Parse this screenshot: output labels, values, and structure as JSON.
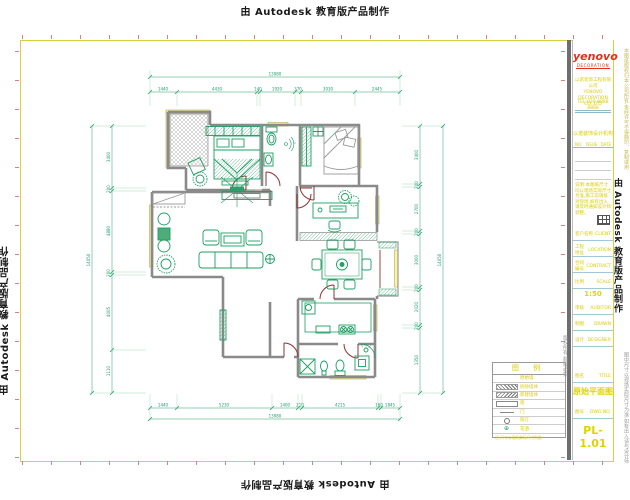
{
  "watermark": "由 Autodesk 教育版产品制作",
  "title_block": {
    "logo_text": "yenovo",
    "logo_sub": "DECORATION",
    "company_cn": "以诺装饰工程有限公司",
    "company_en": "YENOVO DECORATION CO.,LTD",
    "company_tel": "TEL:020-8888 8888",
    "company_line": "以诺装饰设计机构",
    "rev": {
      "no": "NO.",
      "issue": "ISSUE",
      "date": "DATE"
    },
    "para": "说明:本图纸尺寸均以现场实际尺寸为准,施工前请核对现场,如有出入请及时通知设计师调整。",
    "fields": [
      {
        "label": "客户名称",
        "en": "CLIENT",
        "value": ""
      },
      {
        "label": "工程地址",
        "en": "LOCATION",
        "value": ""
      },
      {
        "label": "合同编号",
        "en": "CONTRACT",
        "value": ""
      },
      {
        "label": "比例",
        "en": "SCALE",
        "value": "1:50"
      },
      {
        "label": "审核",
        "en": "AUDITOR",
        "value": ""
      },
      {
        "label": "制图",
        "en": "DRAWN",
        "value": ""
      },
      {
        "label": "设计",
        "en": "DESIGNER",
        "value": ""
      },
      {
        "label": "图名",
        "en": "TITLE",
        "value": "原始平面图"
      },
      {
        "label": "图号",
        "en": "DWG NO.",
        "value": "PL-1.01"
      }
    ],
    "drawing_name": "原始平面图",
    "drawing_no": "PL-1.01"
  },
  "legend": {
    "title": "图 例",
    "rows": [
      {
        "label": "原始墙"
      },
      {
        "label": "拆除墙体"
      },
      {
        "label": "新建墙体"
      },
      {
        "label": "窗"
      },
      {
        "label": "门"
      },
      {
        "label": "筒灯"
      },
      {
        "label": "花洒",
        "glyph": "⊕"
      }
    ],
    "footnote": "注:尺寸以现场实际尺寸为准"
  },
  "side_notes": {
    "right_top": "本图纸版权归本公司所有,未经许可不得翻印、复制或用于其他用途。",
    "right_bottom": "图中尺寸以现场实际尺寸为准,如有出入请与设计师联系。",
    "inner_left": "版权所有 翻版必究"
  },
  "dimensions": {
    "top": {
      "total": "13980",
      "segments": [
        "1440",
        "4430",
        "140",
        "1920",
        "370",
        "3030",
        "2445"
      ]
    },
    "bottom": {
      "total": "13980",
      "segments": [
        "1440",
        "5230",
        "1400",
        "210",
        "4215",
        "160",
        "1845"
      ]
    },
    "left": {
      "total": "14050",
      "segments": [
        "3400",
        "200",
        "4880",
        "200",
        "4005",
        "1110"
      ]
    },
    "right": {
      "total": "14050",
      "segments": [
        "3400",
        "200",
        "2700",
        "200",
        "3000",
        "200",
        "2020",
        "200",
        "1350"
      ]
    }
  },
  "colors": {
    "dim_green": "#2aa06a",
    "furniture_green": "#1d9e63",
    "door_red": "#8b3434",
    "wall_gray": "#8a8a8a",
    "window_yellow": "#fdf3a0",
    "logo_red": "#e23018",
    "label_yellow": "#d8cc00",
    "border_yellow": "#d8d040"
  }
}
